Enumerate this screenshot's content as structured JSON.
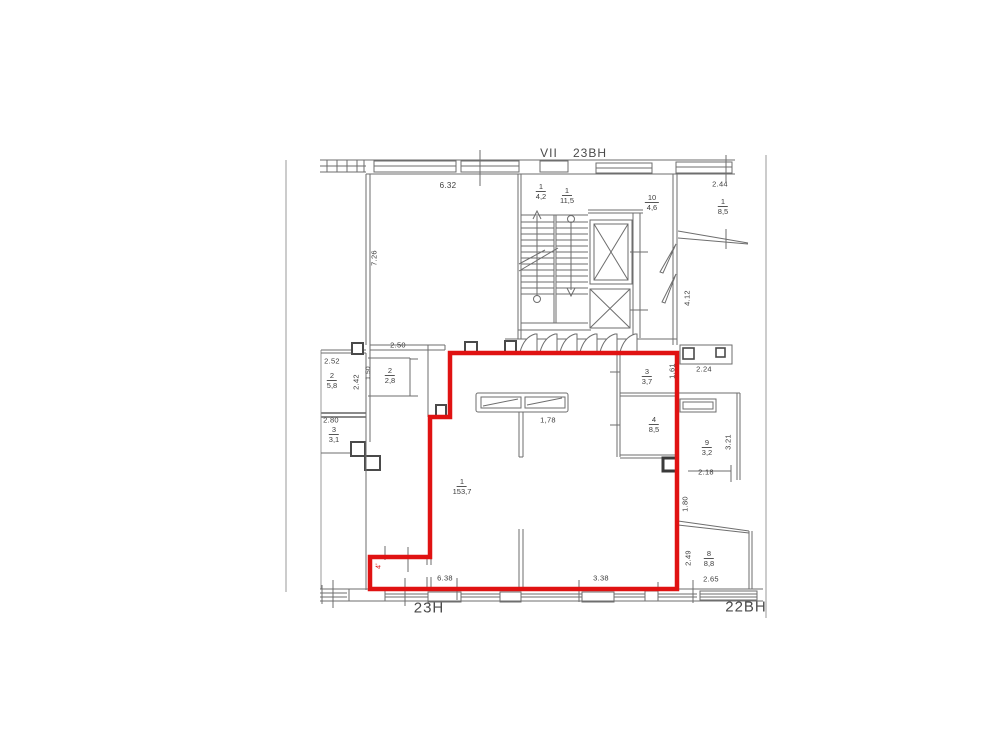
{
  "colors": {
    "red": "#e01212",
    "wall": "#6e6e6e",
    "wall_dark": "#4a4a4a",
    "text": "#3d3d3d"
  },
  "header": {
    "stair_mark": "VII",
    "section_label": "23ВН"
  },
  "footer": {
    "unit_left": "23Н",
    "unit_right": "22ВН"
  },
  "labels": [
    {
      "name": "dim-6-32",
      "text": "6.32",
      "x": 448,
      "y": 186,
      "size": 8
    },
    {
      "name": "dim-7-26",
      "text": "7.26",
      "x": 374,
      "y": 258,
      "rot": true
    },
    {
      "name": "dim-2-44",
      "text": "2.44",
      "x": 720,
      "y": 184
    },
    {
      "name": "dim-2-50",
      "text": "2.50",
      "x": 398,
      "y": 345
    },
    {
      "name": "dim-2-52",
      "text": "2.52",
      "x": 332,
      "y": 361
    },
    {
      "name": "dim-2-42",
      "text": "2.42",
      "x": 356,
      "y": 382,
      "rot": true
    },
    {
      "name": "dim-1-50",
      "text": "1.50",
      "x": 369,
      "y": 373,
      "rot": true,
      "size": 6.5
    },
    {
      "name": "dim-2-80",
      "text": "2.80",
      "x": 331,
      "y": 420
    },
    {
      "name": "dim-1-78",
      "text": "1,78",
      "x": 548,
      "y": 420
    },
    {
      "name": "dim-1-61",
      "text": "1.61",
      "x": 672,
      "y": 371,
      "rot": true
    },
    {
      "name": "dim-2-24",
      "text": "2.24",
      "x": 704,
      "y": 369
    },
    {
      "name": "dim-3-21",
      "text": "3.21",
      "x": 728,
      "y": 442,
      "rot": true
    },
    {
      "name": "dim-2-18",
      "text": "2.18",
      "x": 706,
      "y": 472
    },
    {
      "name": "dim-4-12",
      "text": "4.12",
      "x": 687,
      "y": 298,
      "rot": true
    },
    {
      "name": "dim-1-80",
      "text": "1.80",
      "x": 685,
      "y": 504,
      "rot": true
    },
    {
      "name": "dim-2-49",
      "text": "2.49",
      "x": 688,
      "y": 558,
      "rot": true
    },
    {
      "name": "dim-6-38",
      "text": "6.38",
      "x": 445,
      "y": 578
    },
    {
      "name": "dim-3-38",
      "text": "3.38",
      "x": 601,
      "y": 578
    },
    {
      "name": "dim-2-65",
      "text": "2.65",
      "x": 711,
      "y": 579
    },
    {
      "name": "red-notch-mark",
      "text": "4'",
      "x": 379,
      "y": 566,
      "rot": true,
      "size": 7,
      "color": "#e01212"
    }
  ],
  "fractions": [
    {
      "name": "room-stair-4-2",
      "num": "1",
      "den": "4,2",
      "x": 541,
      "y": 182
    },
    {
      "name": "room-stair-11-5",
      "num": "1",
      "den": "11,5",
      "x": 567,
      "y": 186
    },
    {
      "name": "room-10-4-6",
      "num": "10",
      "den": "4,6",
      "x": 652,
      "y": 193
    },
    {
      "name": "room-1-8-5",
      "num": "1",
      "den": "8,5",
      "x": 723,
      "y": 197
    },
    {
      "name": "room-2-2-8",
      "num": "2",
      "den": "2,8",
      "x": 390,
      "y": 366
    },
    {
      "name": "room-2-5-8",
      "num": "2",
      "den": "5,8",
      "x": 332,
      "y": 371
    },
    {
      "name": "room-3-3-1",
      "num": "3",
      "den": "3,1",
      "x": 334,
      "y": 425
    },
    {
      "name": "room-3-3-7",
      "num": "3",
      "den": "3,7",
      "x": 647,
      "y": 367
    },
    {
      "name": "room-4-8-5",
      "num": "4",
      "den": "8,5",
      "x": 654,
      "y": 415
    },
    {
      "name": "room-1-153-7",
      "num": "1",
      "den": "153,7",
      "x": 462,
      "y": 477
    },
    {
      "name": "room-9-3-2",
      "num": "9",
      "den": "3,2",
      "x": 707,
      "y": 438
    },
    {
      "name": "room-8-8-8",
      "num": "8",
      "den": "8,8",
      "x": 709,
      "y": 549
    }
  ]
}
